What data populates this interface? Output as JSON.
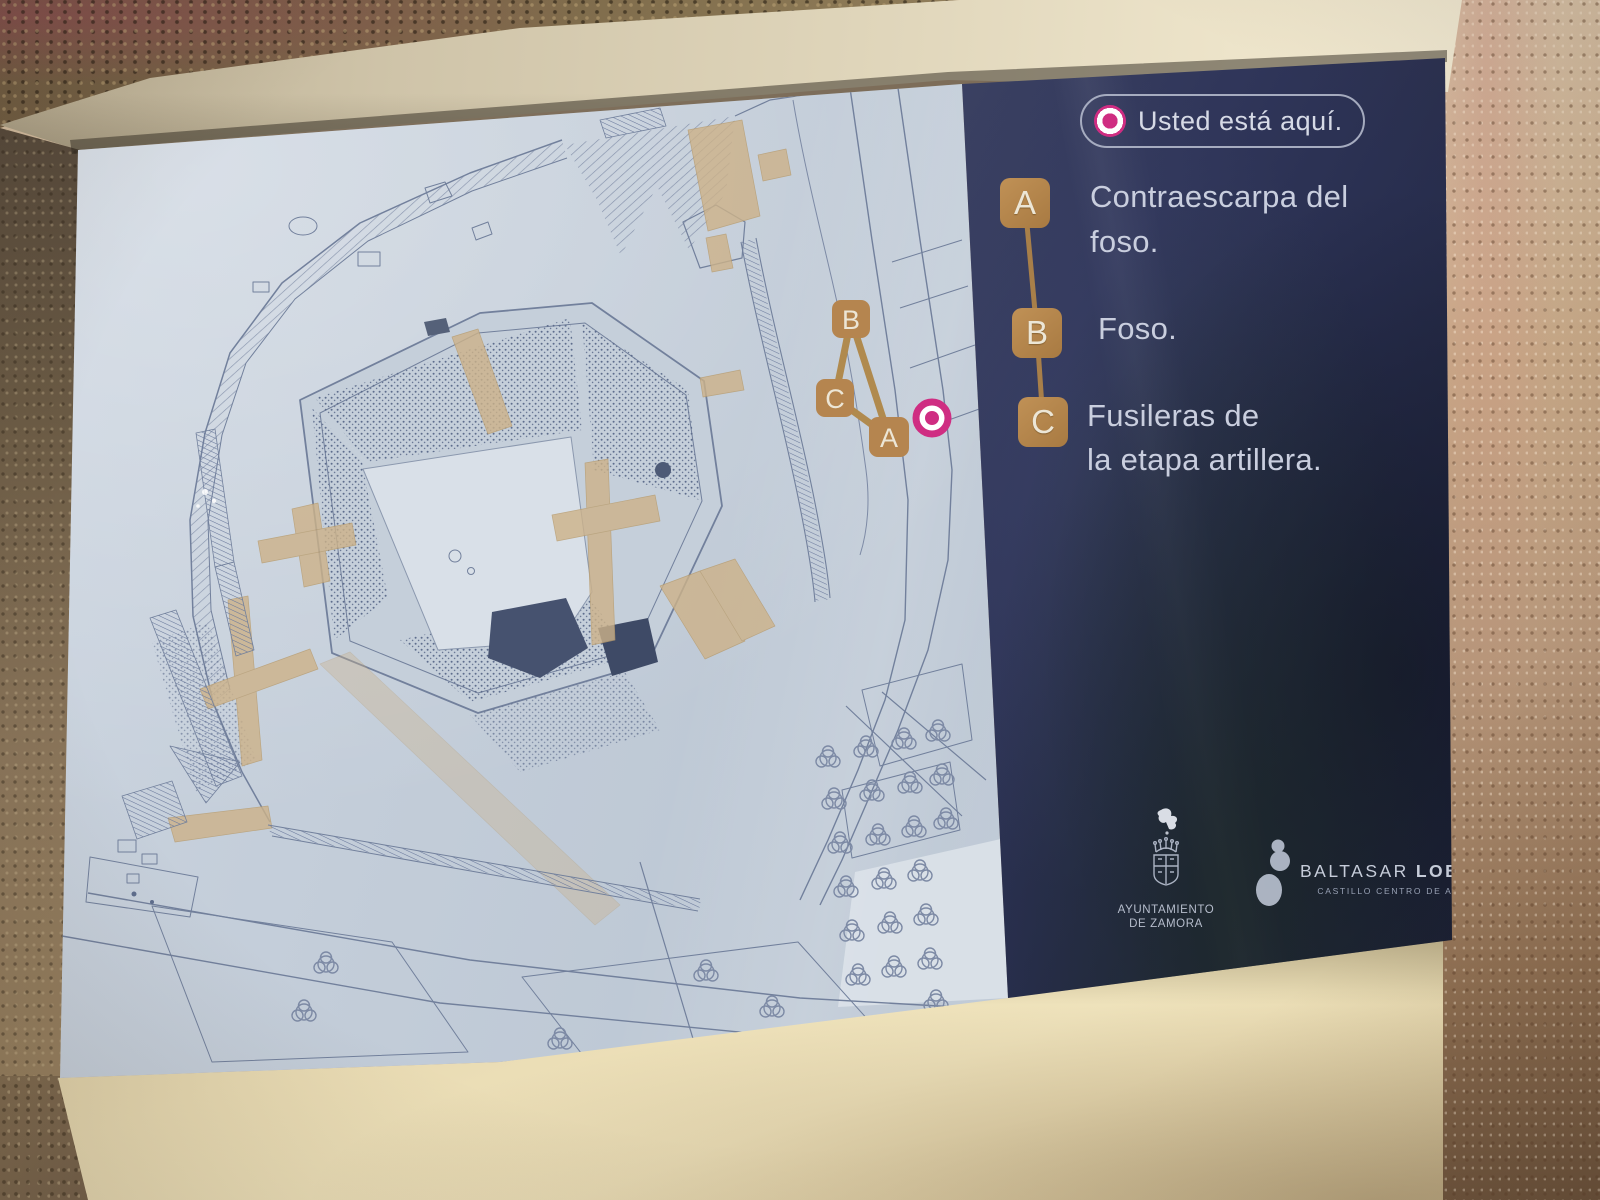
{
  "sign": {
    "you_are_here": {
      "label": "Usted está aquí."
    },
    "legend": {
      "items": [
        {
          "key": "A",
          "label": "Contraescarpa del\nfoso."
        },
        {
          "key": "B",
          "label": "Foso."
        },
        {
          "key": "C",
          "label": "Fusileras de\nla etapa artillera."
        }
      ]
    },
    "map_markers": [
      {
        "key": "B"
      },
      {
        "key": "C"
      },
      {
        "key": "A"
      }
    ],
    "footer": {
      "ayuntamiento": "AYUNTAMIENTO\nDE ZAMORA",
      "baltasar_first": "BALTASAR",
      "baltasar_last": "LOBO",
      "baltasar_subtitle": "CASTILLO CENTRO DE ARTE"
    }
  },
  "colors": {
    "badge_tan": "#b5854f",
    "connector_tan": "#a87f49",
    "magenta": "#cf2d82",
    "panel_navy": "#2c3252",
    "map_panel_blue": "#c6d0dc",
    "legend_text": "#c9cede"
  }
}
